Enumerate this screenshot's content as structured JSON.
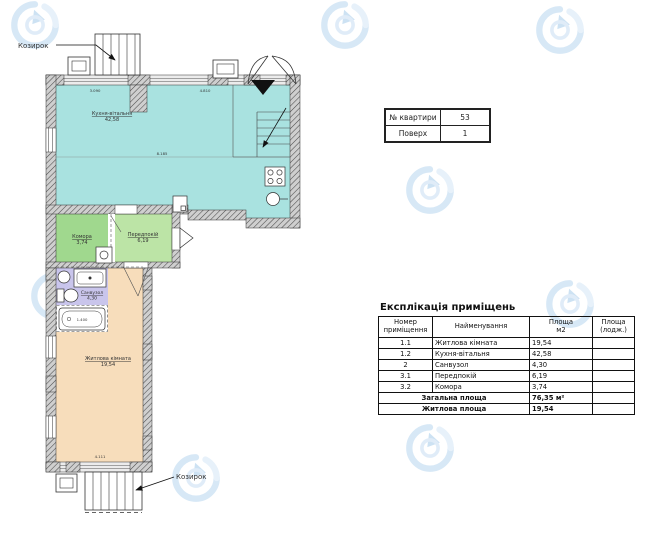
{
  "colors": {
    "kitchen_living": "#a9e2e0",
    "storage": "#a0d88e",
    "hallway": "#bce4a6",
    "bathroom": "#c9c5ec",
    "living_room": "#f7ddbb",
    "watermark": "#b7d6ee",
    "wall_hatch": "#4a4a4a"
  },
  "plan": {
    "canopy_top_label": "Козирок",
    "canopy_bottom_label": "Козирок",
    "rooms": {
      "kitchen": {
        "name": "Кухня-вітальня",
        "area": "42,58"
      },
      "storage": {
        "name": "Комора",
        "area": "3,74"
      },
      "hall": {
        "name": "Передпокій",
        "area": "6,19"
      },
      "bath": {
        "name": "Санвузол",
        "area": "4,30"
      },
      "living": {
        "name": "Житлова кімната",
        "area": "19,54"
      }
    },
    "dims": {
      "top1": "3.090",
      "top2": "4.810",
      "mid": "8.185",
      "tub": "1.400",
      "bottom": "4.111"
    }
  },
  "info_table": {
    "rows": [
      {
        "label": "№ квартири",
        "value": "53"
      },
      {
        "label": "Поверх",
        "value": "1"
      }
    ]
  },
  "explication": {
    "title": "Експлікація приміщень",
    "headers": {
      "number": "Номер\nприміщення",
      "name": "Найменування",
      "area": "Площа\nм2",
      "area_loggia": "Площа\n(лодж.)"
    },
    "rows": [
      {
        "num": "1.1",
        "name": "Житлова кімната",
        "area": "19,54",
        "loggia": ""
      },
      {
        "num": "1.2",
        "name": "Кухня-вітальня",
        "area": "42,58",
        "loggia": ""
      },
      {
        "num": "2",
        "name": "Санвузол",
        "area": "4,30",
        "loggia": ""
      },
      {
        "num": "3.1",
        "name": "Передпокій",
        "area": "6,19",
        "loggia": ""
      },
      {
        "num": "3.2",
        "name": "Комора",
        "area": "3,74",
        "loggia": ""
      }
    ],
    "total_label": "Загальна площа",
    "total_value": "76,35 м²",
    "living_label": "Житлова площа",
    "living_value": "19,54"
  }
}
